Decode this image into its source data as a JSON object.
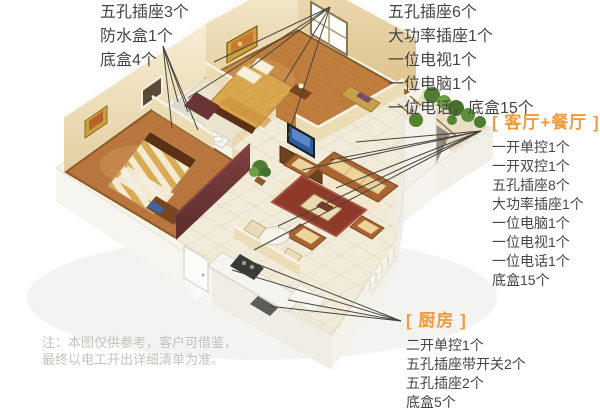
{
  "annotations": {
    "top_left": {
      "items": [
        "五孔插座3个",
        "防水盒1个",
        "底盒4个"
      ]
    },
    "top_right": {
      "items": [
        "五孔插座6个",
        "大功率插座1个",
        "一位电视1个",
        "一位电脑1个",
        "一位电话，底盒15个"
      ]
    },
    "living_dining": {
      "title": "[ 客厅+餐厅 ]",
      "items": [
        "一开单控1个",
        "一开双控1个",
        "五孔插座8个",
        "大功率插座1个",
        "一位电脑1个",
        "一位电视1个",
        "一位电话1个",
        "底盒15个"
      ]
    },
    "kitchen": {
      "title": "[ 厨房 ]",
      "items": [
        "二开单控1个",
        "五孔插座带开关2个",
        "五孔插座2个",
        "底盒5个"
      ]
    }
  },
  "note": {
    "line1": "注：本图仅供参考，客户可借鉴，",
    "line2": "最终以电工开出详细清单为准。"
  },
  "colors": {
    "accent_orange": "#F09B3D",
    "body_text": "#464646",
    "note_text": "#C5C3BF",
    "leader_line": "#45433F",
    "wall_cream": "#F2E6C8",
    "wood_floor": "#BE7C40",
    "rug_red": "#8D3A2B",
    "sofa_cushion": "#E9D198",
    "plant_green": "#55832F",
    "tv_blue": "#3A66A6"
  }
}
